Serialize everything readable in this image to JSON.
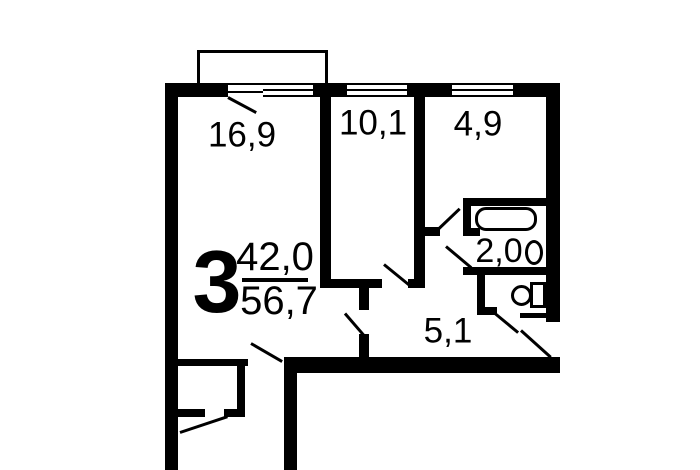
{
  "floor_plan": {
    "rooms_count": "3",
    "living_area": "42,0",
    "total_area": "56,7",
    "room_labels": {
      "living_room": "16,9",
      "bedroom": "10,1",
      "kitchen": "4,9",
      "bathroom": "2,0",
      "hallway": "5,1"
    },
    "colors": {
      "wall": "#000000",
      "background": "#ffffff"
    }
  }
}
